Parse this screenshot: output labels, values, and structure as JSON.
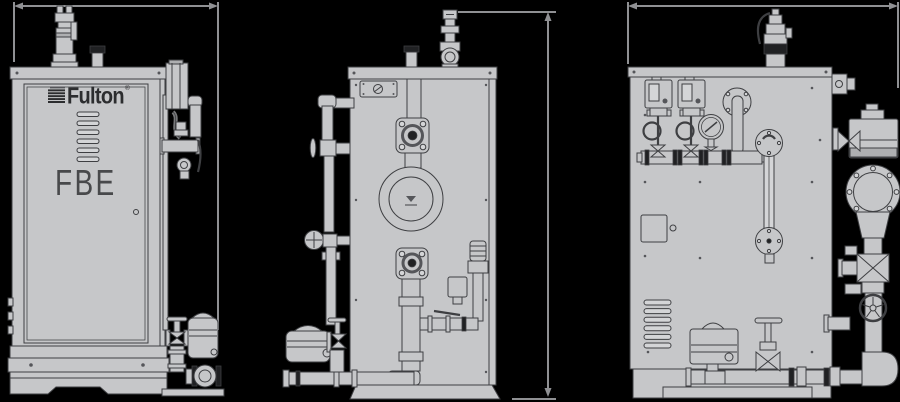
{
  "page": {
    "background": "#000000",
    "description": "Three-view dimensional line drawing of a Fulton FBE electric steam boiler"
  },
  "brand": {
    "logo_text": "Fulton",
    "registered_mark": "®",
    "model_text": "FBE"
  },
  "palette": {
    "body_fill": "#c6c7c9",
    "outline": "#3e3f42",
    "dark_fitting": "#202123",
    "dimension_line": "#8f9093",
    "logo_color": "#2c2d2f",
    "model_color": "#48494b"
  },
  "views": [
    {
      "name": "front-view",
      "components": [
        "safety-valve",
        "exhaust-stack",
        "control-cabinet",
        "fulton-logo",
        "ventilation-louvers",
        "model-label",
        "cabinet-door",
        "side-piping",
        "feedwater-pump",
        "base-skirt"
      ]
    },
    {
      "name": "side-view",
      "components": [
        "safety-valve",
        "exhaust-stack",
        "nameplate",
        "steam-outlet-flange",
        "handhole-flange",
        "lower-flange",
        "blowdown-piping",
        "feedwater-pump",
        "regulator-piping",
        "base-skirt"
      ]
    },
    {
      "name": "rear-view",
      "components": [
        "safety-relief-valve",
        "pressure-controls",
        "pigtail-siphons",
        "pressure-gauge",
        "valve-manifold",
        "water-gauge-glass",
        "junction-box",
        "ventilation-louvers",
        "blowdown-valve-actuator",
        "globe-valve",
        "gate-valve-handwheel",
        "external-piping",
        "base-skirt"
      ]
    }
  ],
  "dimension_lines": [
    {
      "name": "front-overall-width",
      "orientation": "horizontal",
      "labeled": false
    },
    {
      "name": "overall-height",
      "orientation": "vertical",
      "labeled": false
    },
    {
      "name": "rear-overall-width",
      "orientation": "horizontal",
      "labeled": false
    }
  ]
}
